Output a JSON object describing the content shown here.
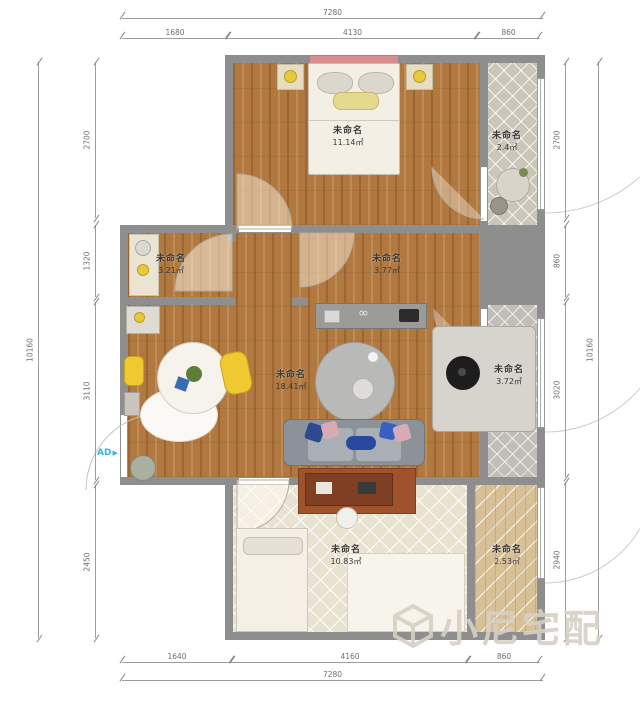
{
  "plan": {
    "type": "floor-plan",
    "unit": "mm",
    "area_unit": "㎡"
  },
  "rooms": [
    {
      "id": "bedroom-top",
      "label": "未命名",
      "area": "11.14㎡"
    },
    {
      "id": "balcony-top",
      "label": "未命名",
      "area": "2.4㎡"
    },
    {
      "id": "kitchen",
      "label": "未命名",
      "area": "3.21㎡"
    },
    {
      "id": "hallway",
      "label": "未命名",
      "area": "3.77㎡"
    },
    {
      "id": "living-room",
      "label": "未命名",
      "area": "18.41㎡"
    },
    {
      "id": "bathroom",
      "label": "未命名",
      "area": "3.72㎡"
    },
    {
      "id": "bedroom-bottom",
      "label": "未命名",
      "area": "10.83㎡"
    },
    {
      "id": "balcony-bottom",
      "label": "未命名",
      "area": "2.53㎡"
    }
  ],
  "dimensions": {
    "top": {
      "overall": "7280",
      "segments": [
        "1680",
        "4130",
        "860"
      ]
    },
    "bottom": {
      "overall": "7280",
      "segments": [
        "1640",
        "4160",
        "860"
      ]
    },
    "left": {
      "overall": "10160",
      "segments": [
        "2700",
        "1320",
        "3110",
        "2450"
      ]
    },
    "right": {
      "overall": "10160",
      "segments": [
        "2700",
        "860",
        "3020",
        "2940"
      ]
    }
  },
  "markers": {
    "ad_label": "AD"
  },
  "icons": {
    "ad_arrow": "▶",
    "glasses": "∞"
  },
  "watermark": {
    "text": "小尼宅配"
  },
  "colors": {
    "wall": "#8e8e8e",
    "wood_floor": "#b1783f",
    "tile_floor": "#ccc5ba",
    "bath_floor": "#c1beb7",
    "cream_floor": "#eae2d1",
    "accent_cyan": "#35b5dd",
    "sofa_navy": "#2e4a8f",
    "chair_yellow": "#eec92f",
    "rug_sienna": "#a0522d",
    "watermark": "#d6d0c5",
    "dim_line": "#9c9c9c"
  }
}
